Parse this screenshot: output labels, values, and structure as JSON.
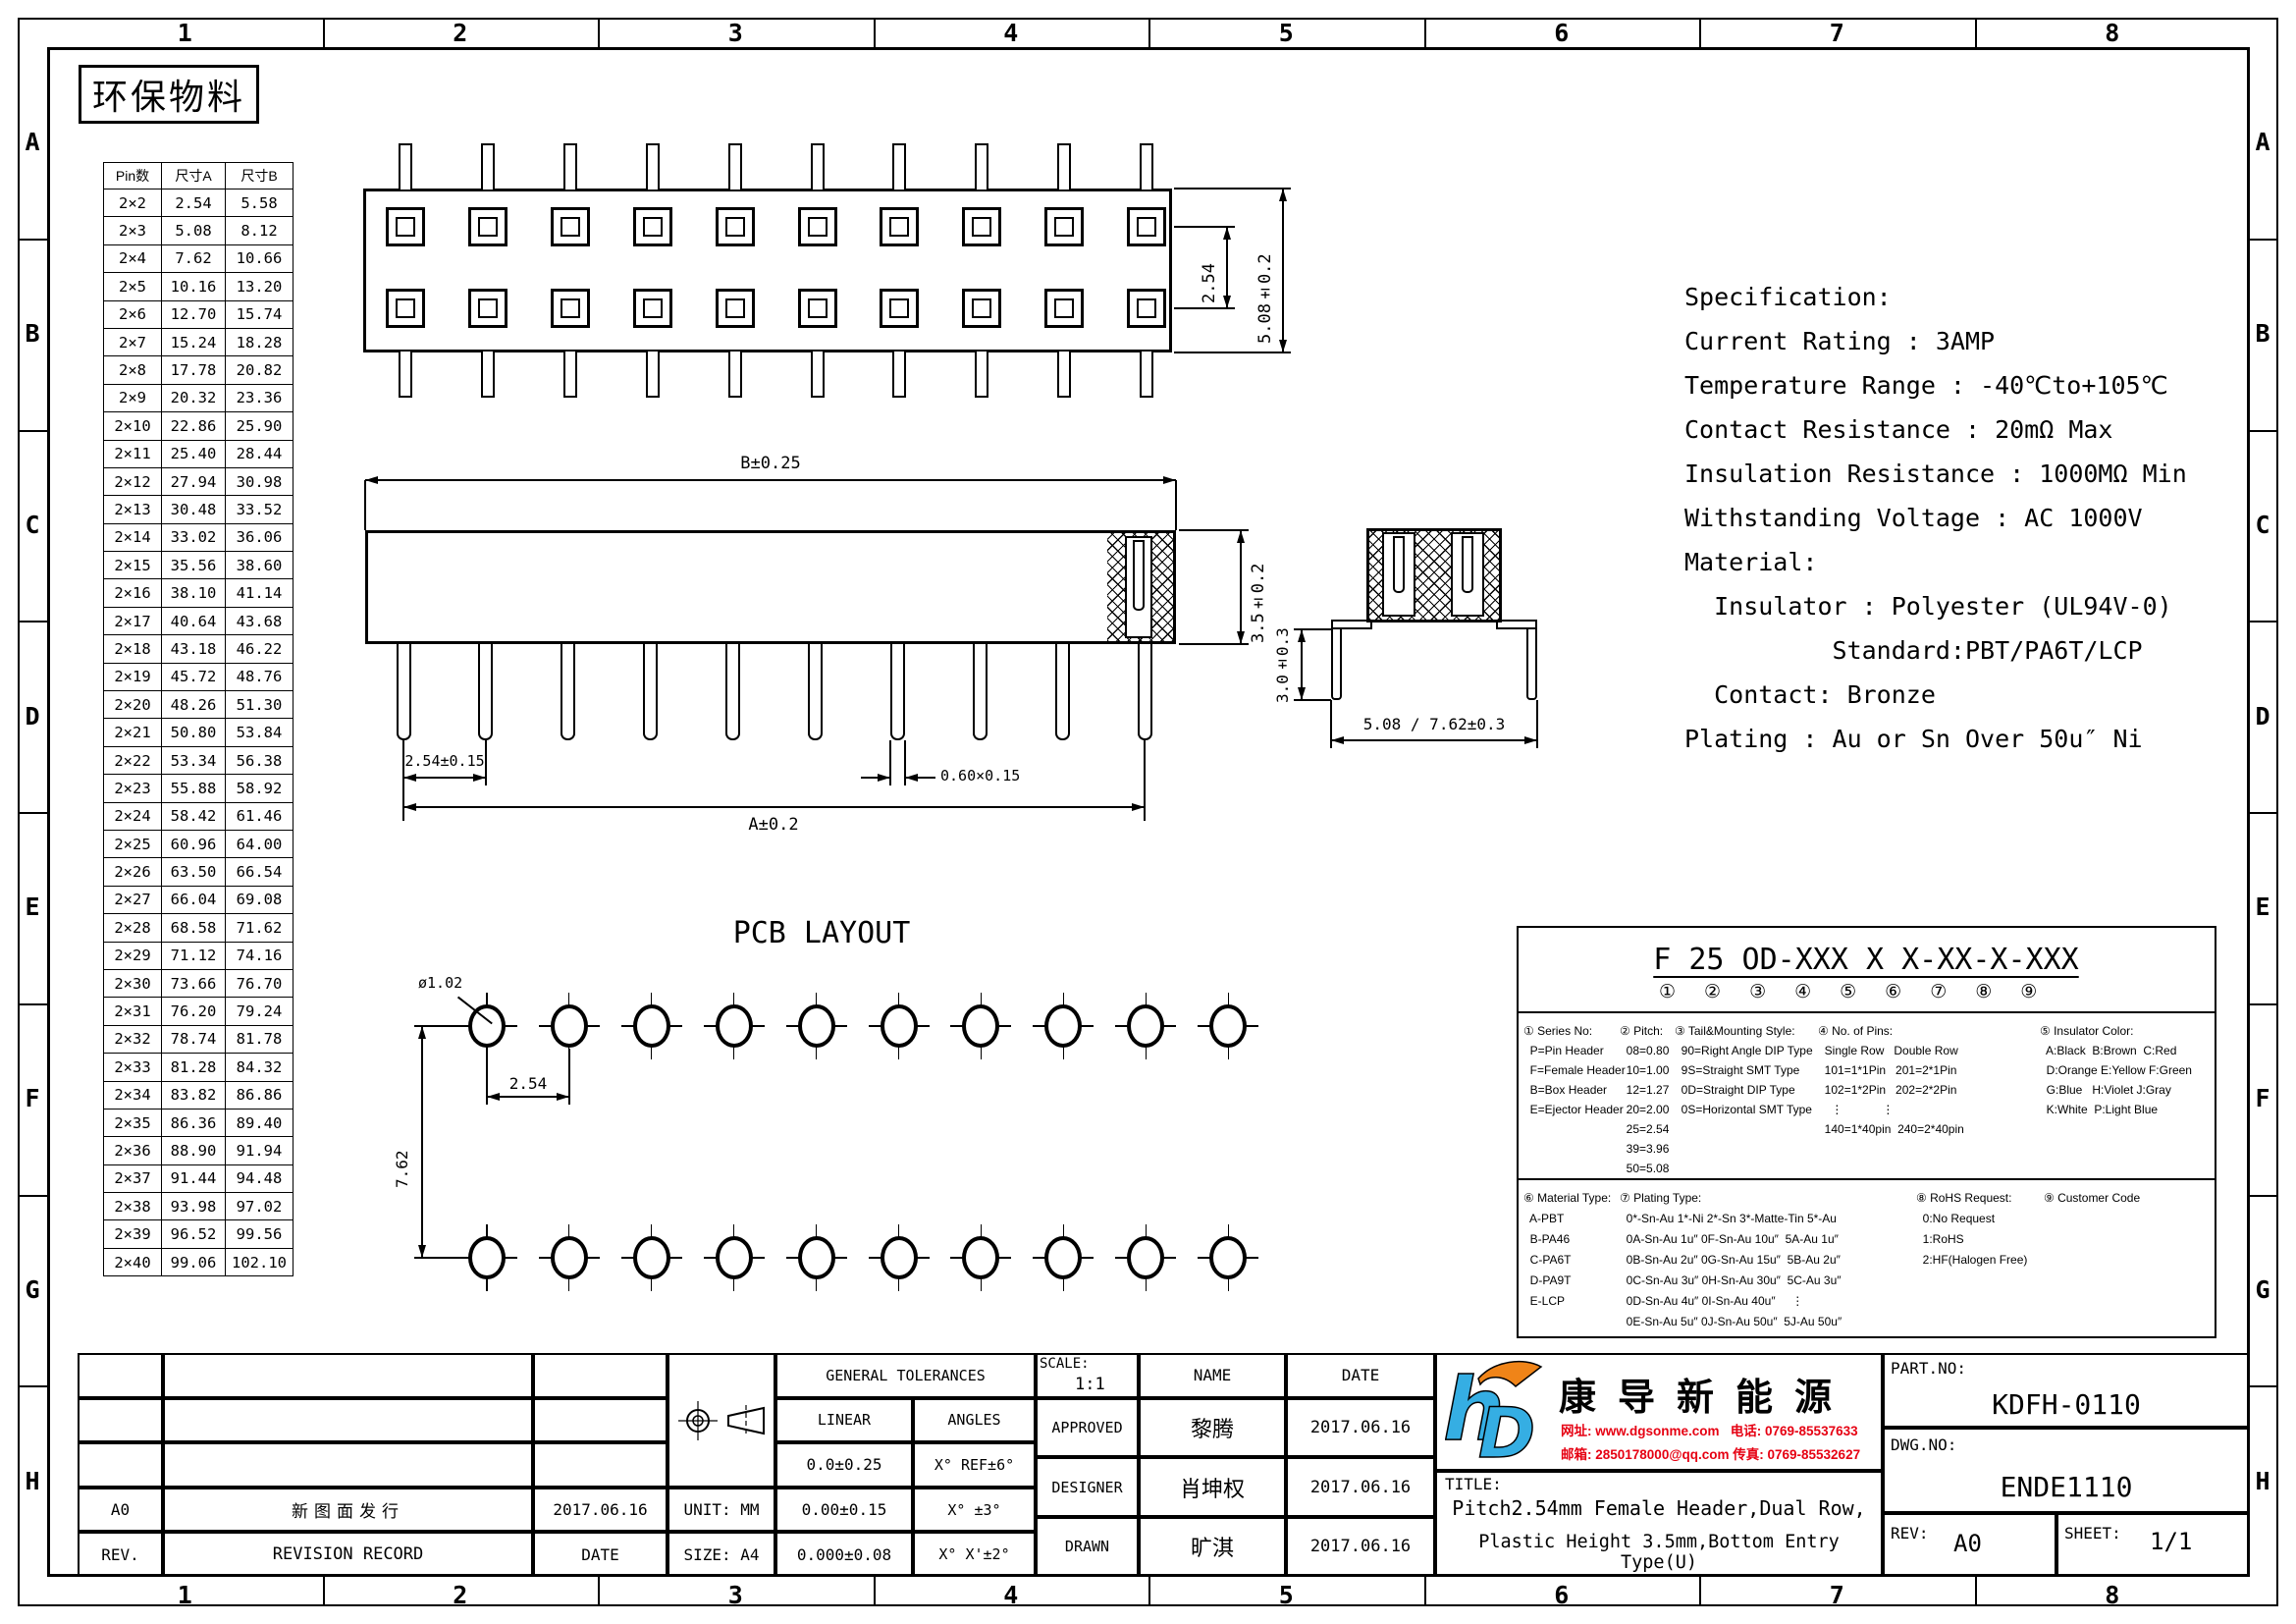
{
  "frame": {
    "columns": [
      "1",
      "2",
      "3",
      "4",
      "5",
      "6",
      "7",
      "8"
    ],
    "rows": [
      "A",
      "B",
      "C",
      "D",
      "E",
      "F",
      "G",
      "H"
    ]
  },
  "stamp": "环保物料",
  "pin_table": {
    "headers": [
      "Pin数",
      "尺寸A",
      "尺寸B"
    ],
    "rows": [
      [
        "2×2",
        "2.54",
        "5.58"
      ],
      [
        "2×3",
        "5.08",
        "8.12"
      ],
      [
        "2×4",
        "7.62",
        "10.66"
      ],
      [
        "2×5",
        "10.16",
        "13.20"
      ],
      [
        "2×6",
        "12.70",
        "15.74"
      ],
      [
        "2×7",
        "15.24",
        "18.28"
      ],
      [
        "2×8",
        "17.78",
        "20.82"
      ],
      [
        "2×9",
        "20.32",
        "23.36"
      ],
      [
        "2×10",
        "22.86",
        "25.90"
      ],
      [
        "2×11",
        "25.40",
        "28.44"
      ],
      [
        "2×12",
        "27.94",
        "30.98"
      ],
      [
        "2×13",
        "30.48",
        "33.52"
      ],
      [
        "2×14",
        "33.02",
        "36.06"
      ],
      [
        "2×15",
        "35.56",
        "38.60"
      ],
      [
        "2×16",
        "38.10",
        "41.14"
      ],
      [
        "2×17",
        "40.64",
        "43.68"
      ],
      [
        "2×18",
        "43.18",
        "46.22"
      ],
      [
        "2×19",
        "45.72",
        "48.76"
      ],
      [
        "2×20",
        "48.26",
        "51.30"
      ],
      [
        "2×21",
        "50.80",
        "53.84"
      ],
      [
        "2×22",
        "53.34",
        "56.38"
      ],
      [
        "2×23",
        "55.88",
        "58.92"
      ],
      [
        "2×24",
        "58.42",
        "61.46"
      ],
      [
        "2×25",
        "60.96",
        "64.00"
      ],
      [
        "2×26",
        "63.50",
        "66.54"
      ],
      [
        "2×27",
        "66.04",
        "69.08"
      ],
      [
        "2×28",
        "68.58",
        "71.62"
      ],
      [
        "2×29",
        "71.12",
        "74.16"
      ],
      [
        "2×30",
        "73.66",
        "76.70"
      ],
      [
        "2×31",
        "76.20",
        "79.24"
      ],
      [
        "2×32",
        "78.74",
        "81.78"
      ],
      [
        "2×33",
        "81.28",
        "84.32"
      ],
      [
        "2×34",
        "83.82",
        "86.86"
      ],
      [
        "2×35",
        "86.36",
        "89.40"
      ],
      [
        "2×36",
        "88.90",
        "91.94"
      ],
      [
        "2×37",
        "91.44",
        "94.48"
      ],
      [
        "2×38",
        "93.98",
        "97.02"
      ],
      [
        "2×39",
        "96.52",
        "99.56"
      ],
      [
        "2×40",
        "99.06",
        "102.10"
      ]
    ]
  },
  "views": {
    "top_view": {
      "dim_pitch": "2.54",
      "dim_width": "5.08±0.2",
      "columns": 10,
      "rows": 2
    },
    "front_view": {
      "dim_b": "B±0.25",
      "dim_height": "3.5±0.2",
      "dim_pitch": "2.54±0.15",
      "dim_pin": "0.60×0.15",
      "dim_a": "A±0.2",
      "pins": 10
    },
    "side_view": {
      "dim_height": "3.0±0.3",
      "dim_span": "5.08 / 7.62±0.3"
    },
    "pcb_layout": {
      "title": "PCB LAYOUT",
      "dim_hole": "ø1.02",
      "dim_pitch": "2.54",
      "dim_row": "7.62",
      "holes": 10,
      "rows": 2
    }
  },
  "specification": {
    "lines": [
      "Specification:",
      "Current Rating : 3AMP",
      "Temperature Range : -40℃to+105℃",
      "Contact Resistance : 20mΩ Max",
      "Insulation Resistance : 1000MΩ Min",
      "Withstanding Voltage : AC 1000V",
      "Material:",
      "  Insulator : Polyester (UL94V-0)",
      "          Standard:PBT/PA6T/LCP",
      "  Contact: Bronze",
      "Plating : Au or Sn Over 50u″ Ni"
    ]
  },
  "ordering": {
    "part_format": "F 25 OD-XXX X X-XX-X-XXX",
    "part_format_marks": "①②③④⑤⑥⑦⑧⑨",
    "sections_top": [
      {
        "lines": [
          "① Series No:",
          "  P=Pin Header",
          "  F=Female Header",
          "  B=Box Header",
          "  E=Ejector Header"
        ]
      },
      {
        "lines": [
          "② Pitch:",
          "  08=0.80",
          "  10=1.00",
          "  12=1.27",
          "  20=2.00",
          "  25=2.54",
          "  39=3.96",
          "  50=5.08"
        ]
      },
      {
        "lines": [
          "③ Tail&Mounting Style:",
          "  90=Right Angle DIP Type",
          "  9S=Straight SMT Type",
          "  0D=Straight DIP Type",
          "  0S=Horizontal SMT Type"
        ]
      },
      {
        "lines": [
          "④ No. of Pins:",
          "  Single Row   Double Row",
          "  101=1*1Pin   201=2*1Pin",
          "  102=1*2Pin   202=2*2Pin",
          "    ⋮            ⋮",
          "  140=1*40pin  240=2*40pin"
        ]
      },
      {
        "lines": [
          "⑤ Insulator Color:",
          "  A:Black  B:Brown  C:Red",
          "  D:Orange E:Yellow F:Green",
          "  G:Blue   H:Violet J:Gray",
          "  K:White  P:Light Blue"
        ]
      }
    ],
    "sections_bottom": [
      {
        "lines": [
          "⑥ Material Type:",
          "  A-PBT",
          "  B-PA46",
          "  C-PA6T",
          "  D-PA9T",
          "  E-LCP"
        ]
      },
      {
        "lines": [
          "⑦ Plating Type:",
          "  0*-Sn-Au 1*-Ni 2*-Sn 3*-Matte-Tin 5*-Au",
          "  0A-Sn-Au 1u″ 0F-Sn-Au 10u″  5A-Au 1u″",
          "  0B-Sn-Au 2u″ 0G-Sn-Au 15u″  5B-Au 2u″",
          "  0C-Sn-Au 3u″ 0H-Sn-Au 30u″  5C-Au 3u″",
          "  0D-Sn-Au 4u″ 0I-Sn-Au 40u″     ⋮",
          "  0E-Sn-Au 5u″ 0J-Sn-Au 50u″  5J-Au 50u″"
        ]
      },
      {
        "lines": [
          "⑧ RoHS Request:",
          "  0:No Request",
          "  1:RoHS",
          "  2:HF(Halogen Free)"
        ]
      },
      {
        "lines": [
          "⑨ Customer Code"
        ]
      }
    ]
  },
  "title_block": {
    "general_tolerances": {
      "title": "GENERAL TOLERANCES",
      "linear_label": "LINEAR",
      "angles_label": "ANGLES",
      "rows": [
        [
          "0.0±0.25",
          "X° REF±6°"
        ],
        [
          "0.00±0.15",
          "X° ±3°"
        ],
        [
          "0.000±0.08",
          "X° X'±2°"
        ]
      ]
    },
    "unit": "UNIT: MM",
    "size": "SIZE: A4",
    "scale_label": "SCALE:",
    "scale_value": "1:1",
    "name_label": "NAME",
    "date_label": "DATE",
    "signoff": [
      {
        "role": "APPROVED",
        "name": "黎腾",
        "date": "2017.06.16"
      },
      {
        "role": "DESIGNER",
        "name": "肖坤权",
        "date": "2017.06.16"
      },
      {
        "role": "DRAWN",
        "name": "旷淇",
        "date": "2017.06.16"
      }
    ],
    "revision": {
      "rev": "A0",
      "record": "新图面发行",
      "date": "2017.06.16",
      "rev_label": "REV.",
      "record_label": "REVISION RECORD",
      "date_label": "DATE",
      "left_date": "2017.06.16"
    },
    "company": {
      "name": "康导新能源",
      "line1": "网址: www.dgsonme.com   电话: 0769-85537633",
      "line2": "邮箱: 2850178000@qq.com 传真: 0769-85532627"
    },
    "part": {
      "part_no_label": "PART.NO:",
      "part_no": "KDFH-0110",
      "dwg_no_label": "DWG.NO:",
      "dwg_no": "ENDE1110",
      "title_label": "TITLE:",
      "title_line1": "Pitch2.54mm Female Header,Dual Row,",
      "title_line2": "Plastic Height 3.5mm,Bottom Entry Type(U)",
      "rev_label": "REV:",
      "rev": "A0",
      "sheet_label": "SHEET:",
      "sheet": "1/1"
    },
    "colors": {
      "line": "#000000",
      "logo_blue": "#35aee3",
      "logo_orange": "#f08418",
      "contact_red": "#e60012"
    }
  }
}
